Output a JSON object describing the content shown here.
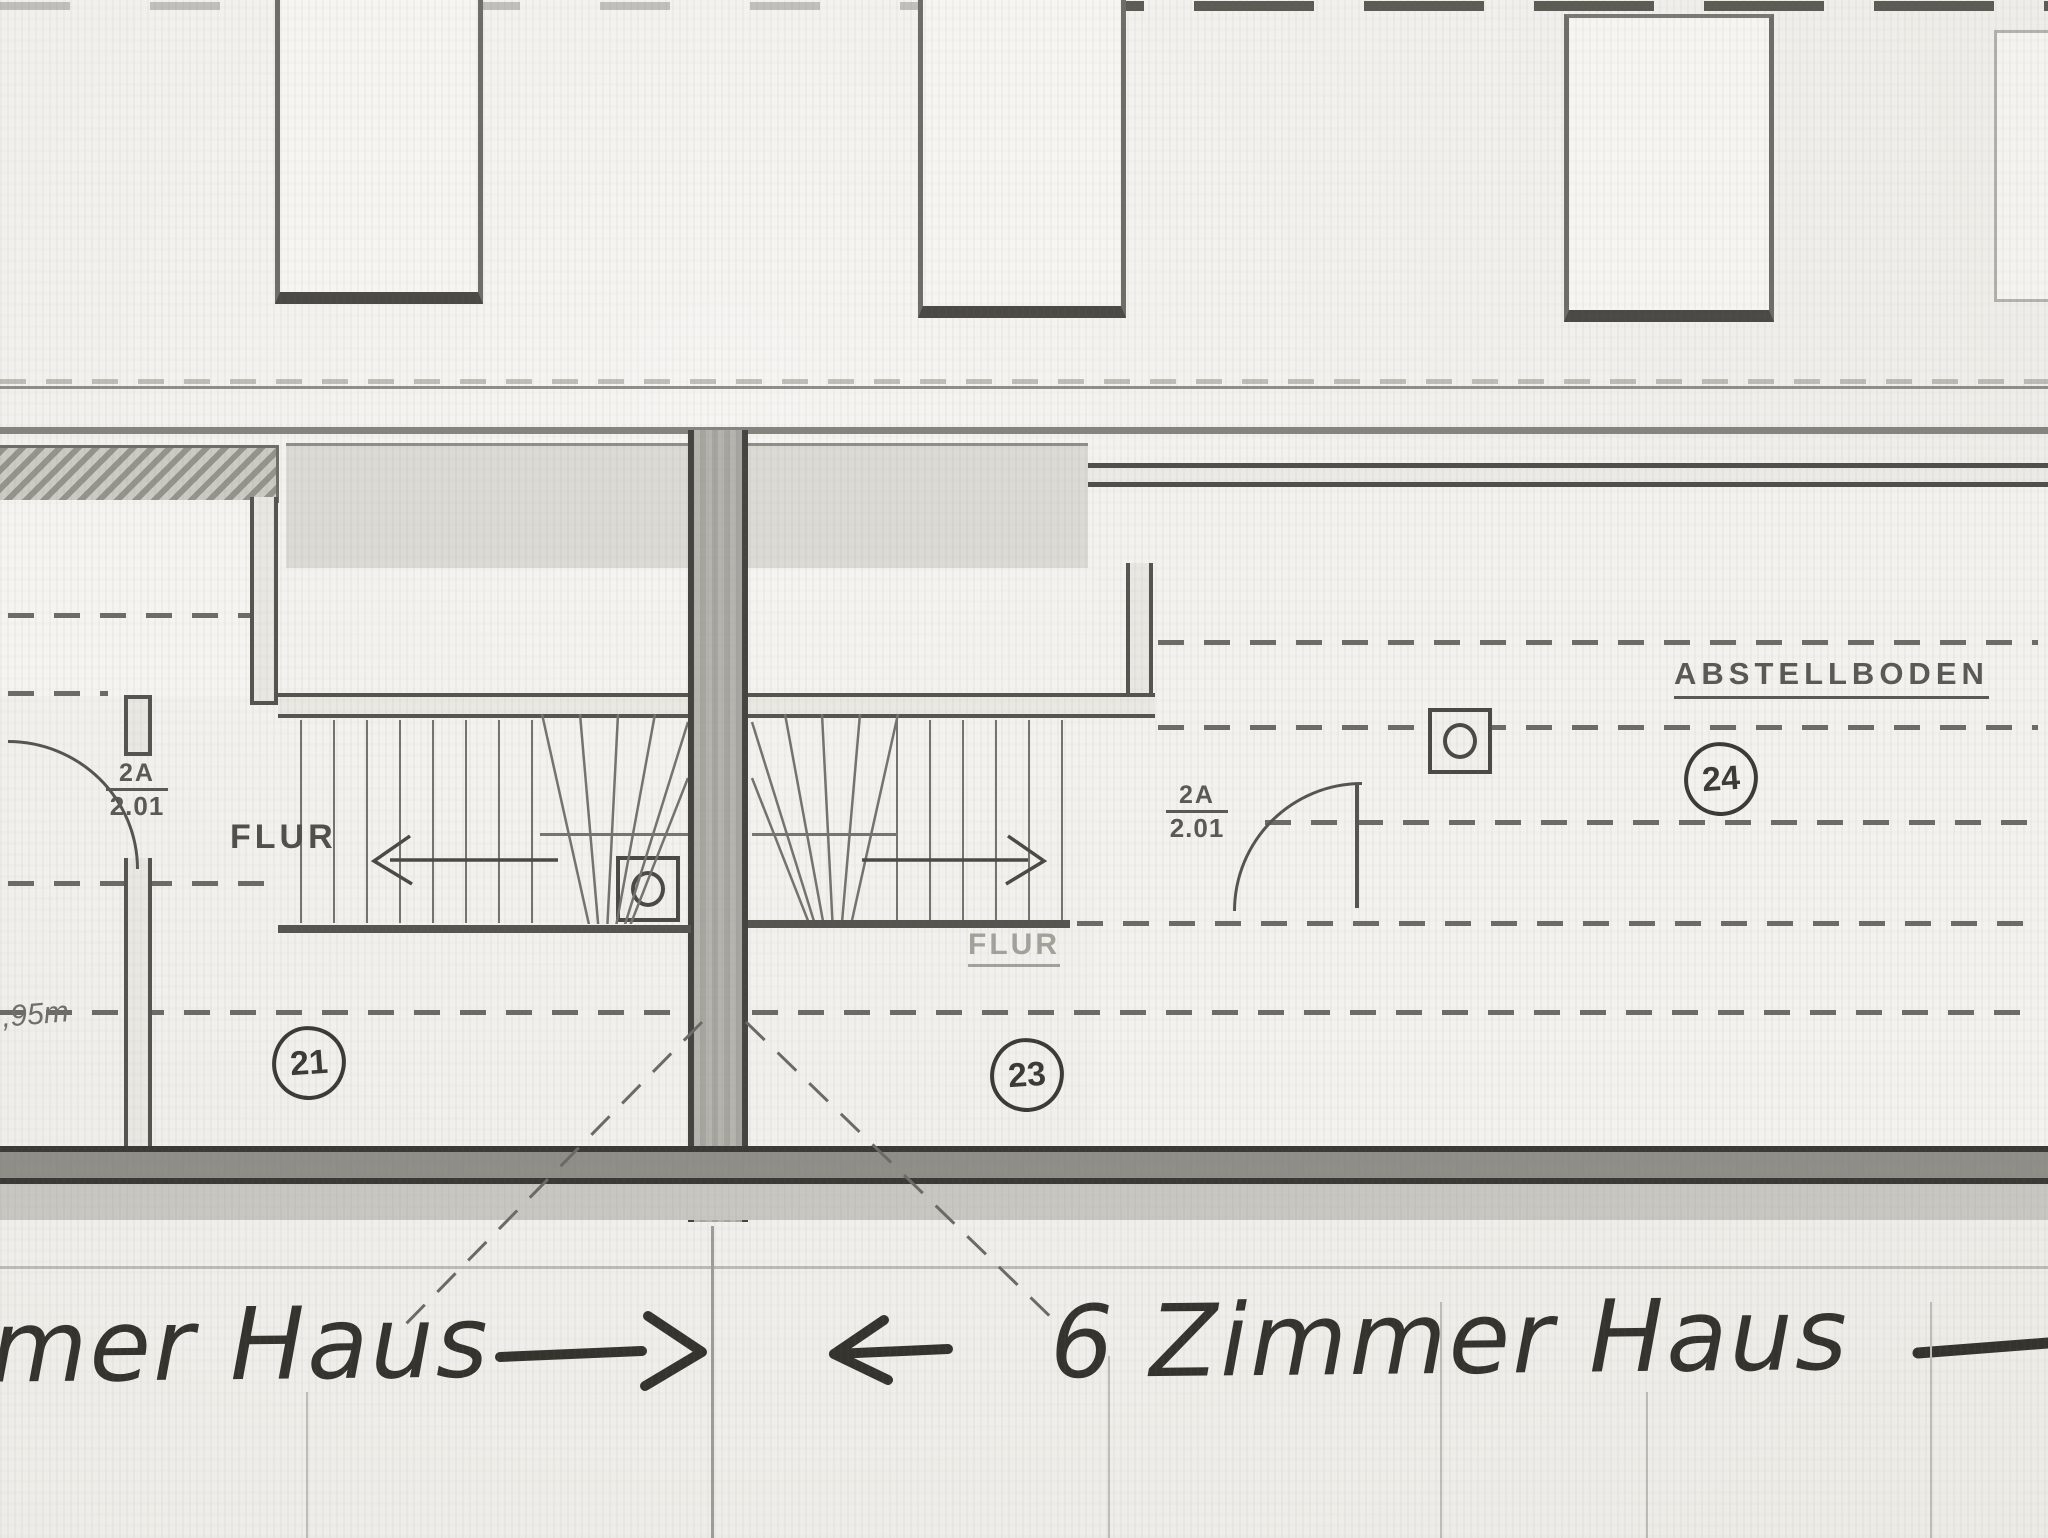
{
  "annotations": {
    "left_house_label": "mer Haus",
    "right_house_label": "6 Zimmer Haus"
  },
  "left_unit": {
    "room_number": "21",
    "hall_label": "FLUR",
    "door_tag_line1": "2A",
    "door_tag_line2": "2.01",
    "dimension": ",95m"
  },
  "right_unit": {
    "room_number": "23",
    "hall_label": "FLUR",
    "attic_label": "ABSTELLBODEN",
    "attic_number": "24",
    "door_tag_line1": "2A",
    "door_tag_line2": "2.01"
  }
}
